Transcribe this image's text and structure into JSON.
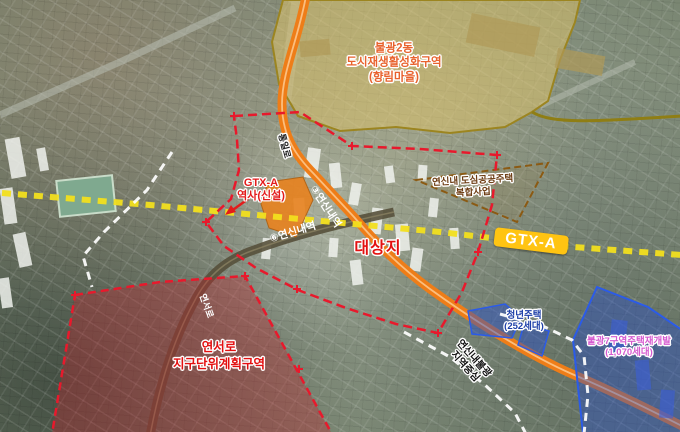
{
  "labels": {
    "regeneration_zone": {
      "line1": "불광2동",
      "line2": "도시재생활성화구역",
      "line3": "(향림마을)"
    },
    "gtx_station": {
      "line1": "GTX-A",
      "line2": "역사(신설)"
    },
    "subway_line3_station": "③연신내역",
    "subway_line6_station": "⑥연신내역",
    "site": "대상지",
    "public_housing_project": {
      "line1": "연신내 도심공공주택",
      "line2": "복합사업"
    },
    "gtx_badge": "GTX-A",
    "youth_housing": {
      "line1": "청년주택",
      "line2": "(252세대)"
    },
    "redevelopment_zone": {
      "line1": "불광7구역주택재개발",
      "line2": "(1,070세대)"
    },
    "district_unit_plan_zone": {
      "line1": "연서로",
      "line2": "지구단위계획구역"
    },
    "yeonseo_road": "연서로",
    "tongil_road": "통일로",
    "district_center": {
      "line1": "연신내불광",
      "line2": "지역중심"
    }
  },
  "colors": {
    "boundary_red": "#e8192c",
    "site_text_red": "#e31010",
    "regeneration_fill": "#e3c468",
    "regeneration_text": "#e8622d",
    "gtx_badge_yellow": "#ffc412",
    "gtx_line_yellow": "#f2df1e",
    "road_orange": "#ee7d18",
    "road_dark_olive": "#57503b",
    "project_text_brown": "#6b3a10",
    "youth_housing_blue": "#1d3fa8",
    "redevelopment_magenta": "#d65bd0",
    "zone_blue": "#2b5be8",
    "district_boundary_white": "#ffffff"
  }
}
